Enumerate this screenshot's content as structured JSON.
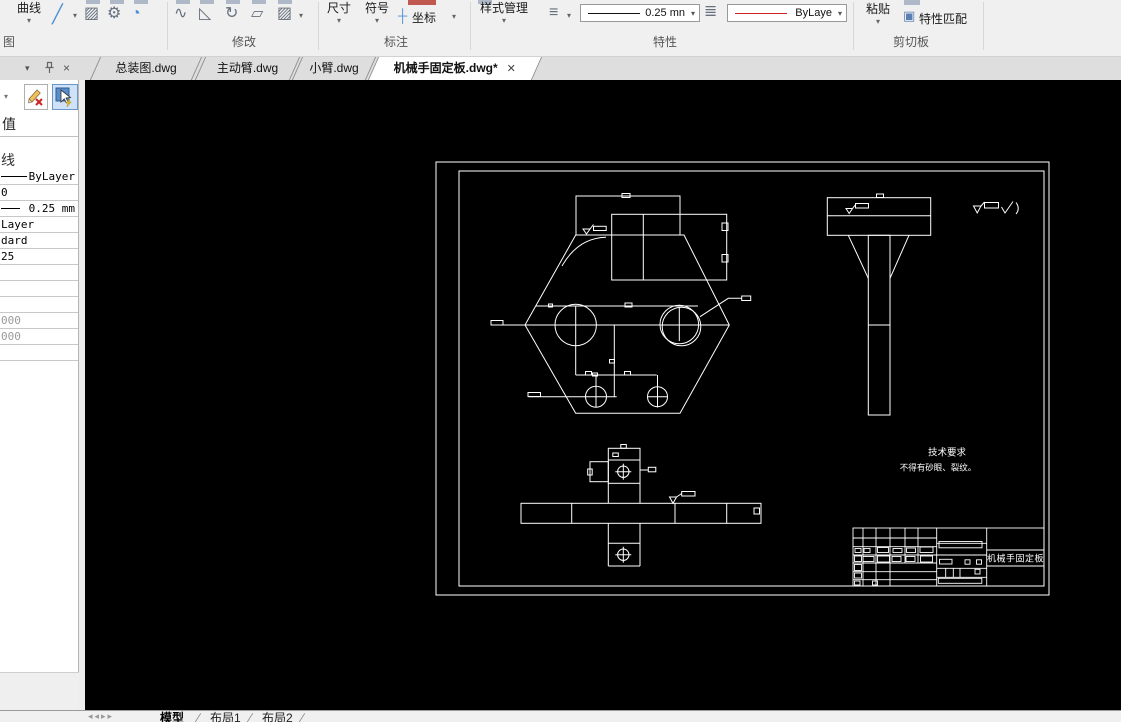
{
  "ribbon": {
    "curve": "曲线",
    "group_draw": "图",
    "group_modify": "修改",
    "dim": "尺寸",
    "symbol": "符号",
    "coord": "坐标",
    "group_annotate": "标注",
    "style_mgr": "样式管理",
    "lineweight": "0.25 mn",
    "color": "ByLaye",
    "group_props": "特性",
    "paste": "粘贴",
    "match_props": "特性匹配",
    "group_clipboard": "剪切板"
  },
  "doc_tabs": [
    {
      "label": "总装图.dwg"
    },
    {
      "label": "主动臂.dwg"
    },
    {
      "label": "小臂.dwg"
    },
    {
      "label": "机械手固定板.dwg*"
    }
  ],
  "panel": {
    "value_header": "值",
    "rows": [
      {
        "text": ""
      },
      {
        "text": "线"
      },
      {
        "text": "ByLayer"
      },
      {
        "text": "0"
      },
      {
        "text": "0.25 mm"
      },
      {
        "text": "Layer"
      },
      {
        "text": "dard"
      },
      {
        "text": "25"
      },
      {
        "text": ""
      },
      {
        "text": ""
      },
      {
        "text": ""
      },
      {
        "text": "000"
      },
      {
        "text": "000"
      },
      {
        "text": ""
      }
    ]
  },
  "drawing": {
    "tech_title": "技术要求",
    "tech_note": "不得有砂眼、裂纹。",
    "part_name": "机械手固定板"
  },
  "status_tabs": [
    {
      "label": "模型"
    },
    {
      "label": "布局1"
    },
    {
      "label": "布局2"
    }
  ]
}
